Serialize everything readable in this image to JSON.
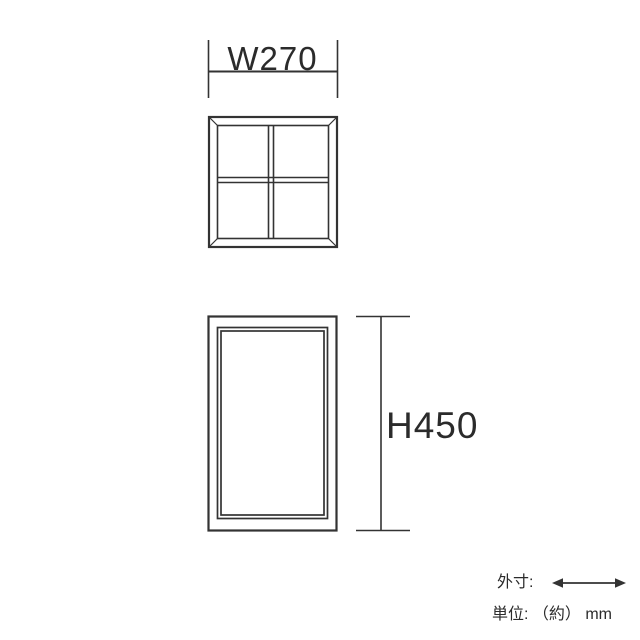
{
  "colors": {
    "line": "#333333",
    "text": "#2b2b2b",
    "background": "#ffffff"
  },
  "dimensions": {
    "width_label": "W270",
    "height_label": "H450",
    "width_value_mm": 270,
    "height_value_mm": 450
  },
  "legend": {
    "outer_size_label": "外寸:",
    "arrow_icon": "left-right-arrow",
    "unit_label": "単位: （約） mm"
  }
}
